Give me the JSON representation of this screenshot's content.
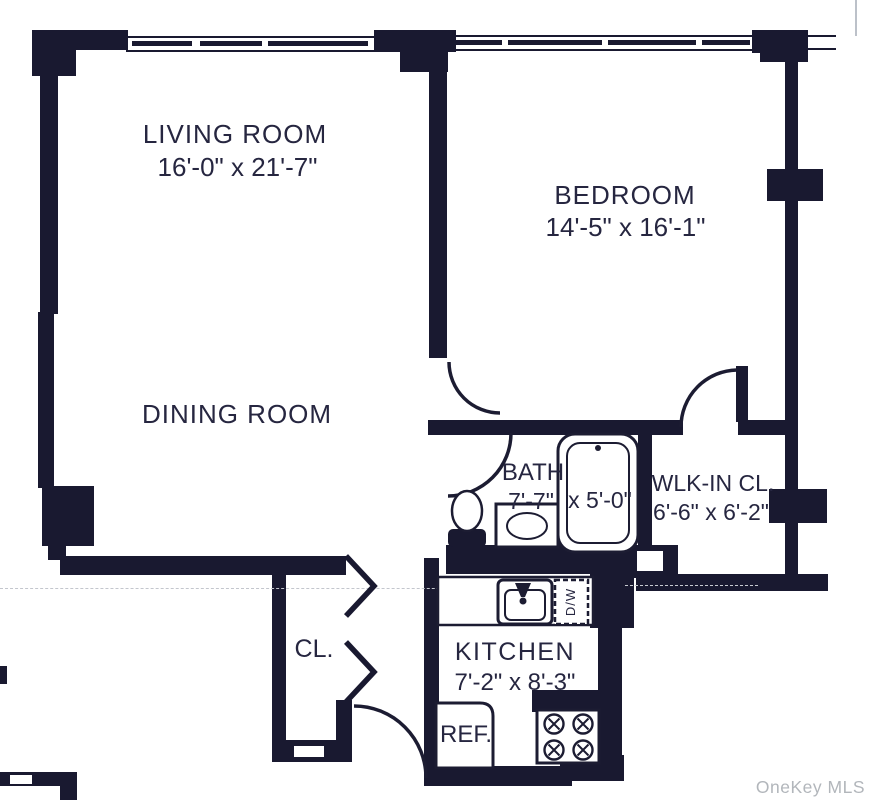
{
  "floorplan": {
    "colors": {
      "wall": "#191930",
      "text": "#262640",
      "watermark": "#b2b6bb"
    },
    "rooms": {
      "living_room": {
        "name": "LIVING ROOM",
        "dims": "16'-0\" x 21'-7\""
      },
      "dining_room": {
        "name": "DINING ROOM"
      },
      "bedroom": {
        "name": "BEDROOM",
        "dims": "14'-5\" x 16'-1\""
      },
      "bath": {
        "name": "BATH",
        "dim_a": "7'-7\"",
        "dim_b": "x 5'-0\""
      },
      "walk_in_closet": {
        "name": "WLK-IN CL.",
        "dims": "6'-6\" x 6'-2\""
      },
      "closet": {
        "name": "CL."
      },
      "kitchen": {
        "name": "KITCHEN",
        "dims": "7'-2\" x 8'-3\""
      }
    },
    "appliances": {
      "refrigerator": "REF.",
      "dishwasher": "D/W"
    },
    "watermark": "OneKey MLS"
  }
}
